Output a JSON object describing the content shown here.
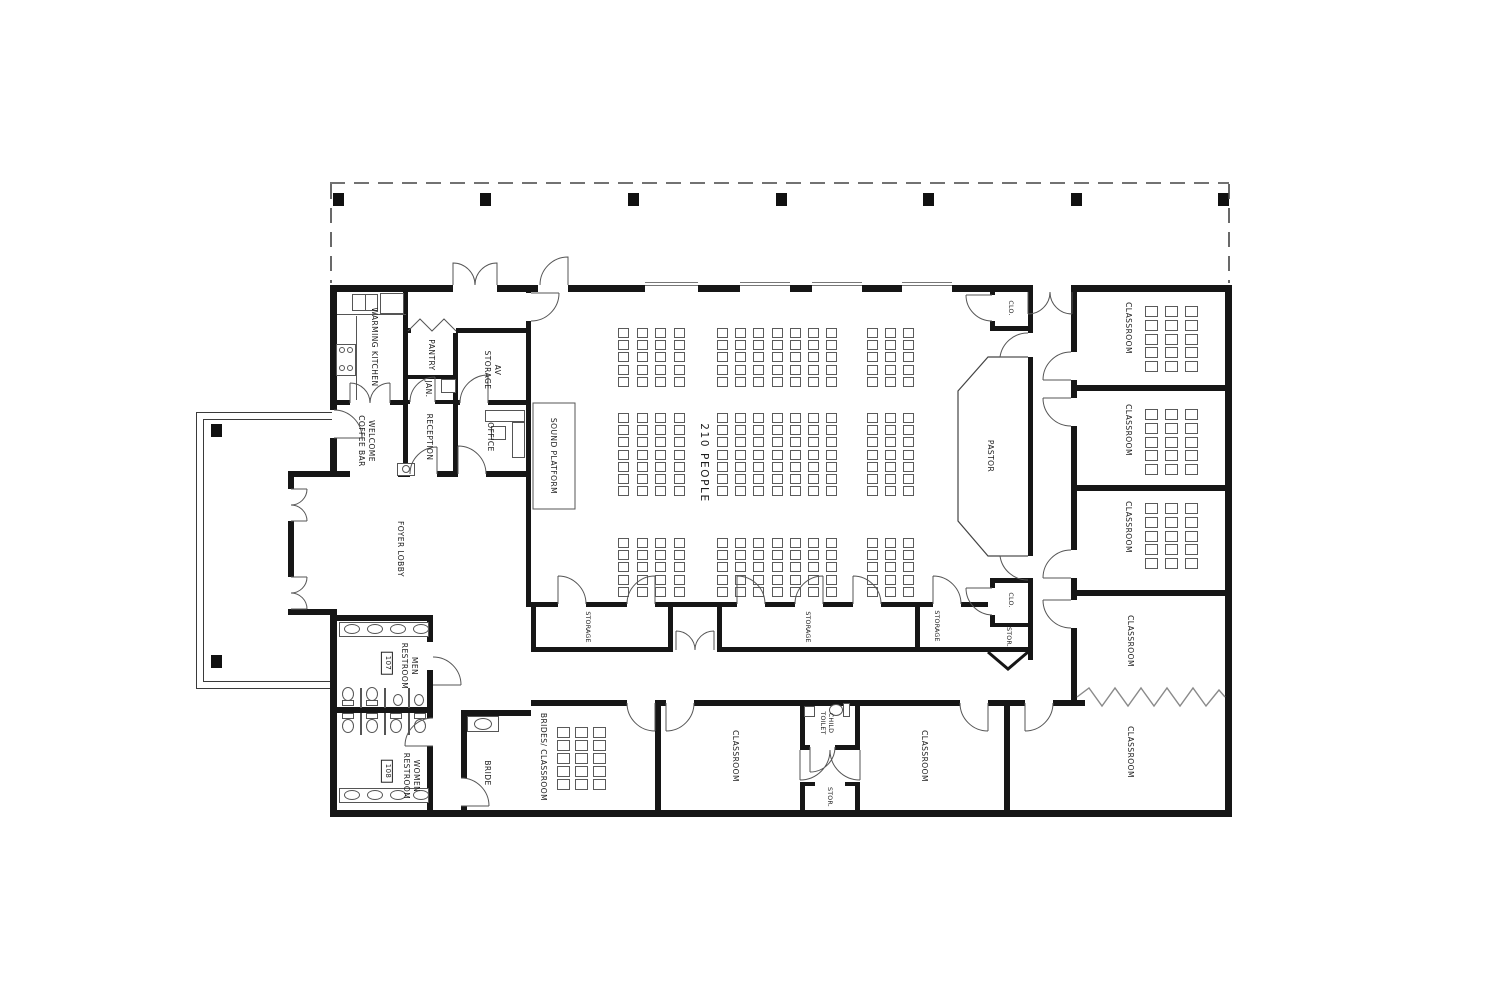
{
  "title": "CHURCH FLOOR PLAN",
  "labels": {
    "warming_kitchen": "WARMING KITCHEN",
    "pantry": "PANTRY",
    "janitor": "JAN.",
    "av_storage": "AV\nSTORAGE",
    "reception": "RECEPTION",
    "office": "OFFICE",
    "welcome_coffee_bar": "WELCOME\nCOFFEE BAR",
    "foyer_lobby": "FOYER LOBBY",
    "sound_platform": "SOUND PLATFORM",
    "capacity": "210 PEOPLE",
    "pastor": "PASTOR",
    "clo": "CLO.",
    "stor": "STOR.",
    "storage": "STORAGE",
    "men_restroom": "MEN\nRESTROOM",
    "men_number": "107",
    "women_restroom": "WOMEN\nRESTROOM",
    "women_number": "108",
    "bride": "BRIDE",
    "brides_classroom": "BRIDES/ CLASSROOM",
    "child_toilet": "CHILD\nTOILET",
    "classroom": "CLASSROOM"
  },
  "seating": {
    "blocks": [
      {
        "x": 618,
        "y": 328,
        "cols": 4,
        "rows": 5,
        "dx": 18.5,
        "dy": 12.2,
        "w": 11,
        "h": 10
      },
      {
        "x": 717,
        "y": 328,
        "cols": 7,
        "rows": 5,
        "dx": 18.2,
        "dy": 12.2,
        "w": 11,
        "h": 10
      },
      {
        "x": 867,
        "y": 328,
        "cols": 3,
        "rows": 5,
        "dx": 18.0,
        "dy": 12.2,
        "w": 11,
        "h": 10
      },
      {
        "x": 618,
        "y": 413,
        "cols": 4,
        "rows": 7,
        "dx": 18.5,
        "dy": 12.2,
        "w": 11,
        "h": 10
      },
      {
        "x": 717,
        "y": 413,
        "cols": 7,
        "rows": 7,
        "dx": 18.2,
        "dy": 12.2,
        "w": 11,
        "h": 10
      },
      {
        "x": 867,
        "y": 413,
        "cols": 3,
        "rows": 7,
        "dx": 18.0,
        "dy": 12.2,
        "w": 11,
        "h": 10
      },
      {
        "x": 618,
        "y": 538,
        "cols": 4,
        "rows": 5,
        "dx": 18.5,
        "dy": 12.2,
        "w": 11,
        "h": 10
      },
      {
        "x": 717,
        "y": 538,
        "cols": 7,
        "rows": 5,
        "dx": 18.2,
        "dy": 12.2,
        "w": 11,
        "h": 10
      },
      {
        "x": 867,
        "y": 538,
        "cols": 3,
        "rows": 5,
        "dx": 18.0,
        "dy": 12.2,
        "w": 11,
        "h": 10
      },
      {
        "x": 1145,
        "y": 306,
        "cols": 3,
        "rows": 5,
        "dx": 20,
        "dy": 13.8,
        "w": 13,
        "h": 11
      },
      {
        "x": 1145,
        "y": 409,
        "cols": 3,
        "rows": 5,
        "dx": 20,
        "dy": 13.8,
        "w": 13,
        "h": 11
      },
      {
        "x": 1145,
        "y": 503,
        "cols": 3,
        "rows": 5,
        "dx": 20,
        "dy": 13.8,
        "w": 13,
        "h": 11
      },
      {
        "x": 557,
        "y": 727,
        "cols": 3,
        "rows": 5,
        "dx": 18,
        "dy": 13,
        "w": 13,
        "h": 11
      }
    ]
  }
}
